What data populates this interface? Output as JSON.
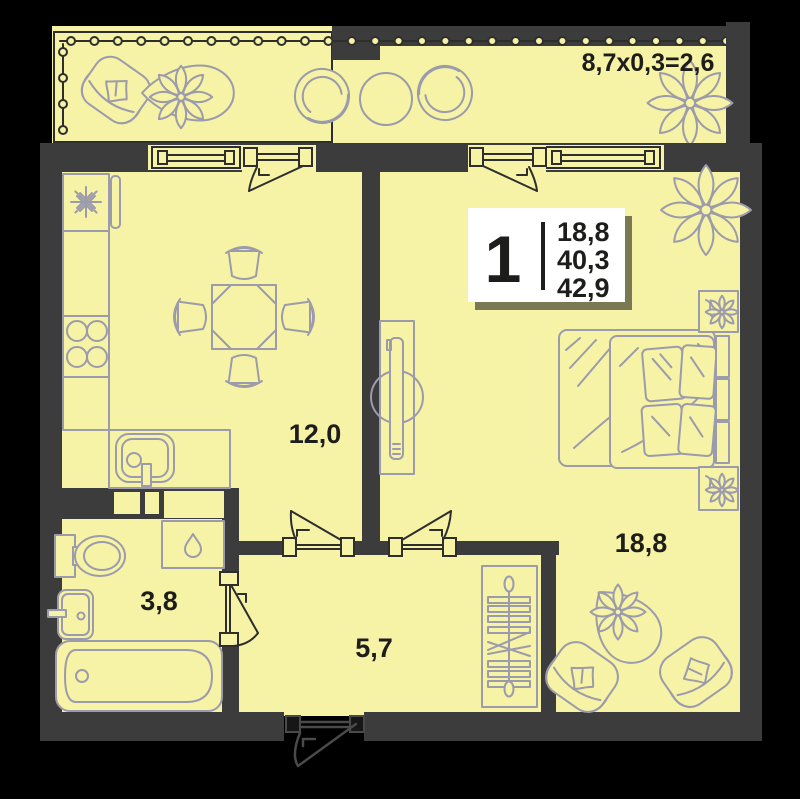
{
  "colors": {
    "background": "#000000",
    "floor": "#f6f2a6",
    "wall": "#3c3c3c",
    "frame": "#2e2e2e",
    "furniture": "#9b9bab",
    "text": "#1d1d1b",
    "info_box": "#ffffff",
    "entrance": "#4a4a4a"
  },
  "plan": {
    "type": "apartment-floor-plan",
    "balcony_dimension": "8,7x0,3=2,6",
    "info_box": {
      "rooms": "1",
      "areas": [
        "18,8",
        "40,3",
        "42,9"
      ]
    },
    "room_labels": {
      "living_kitchen": "12,0",
      "bedroom": "18,8",
      "bathroom": "3,8",
      "hallway": "5,7"
    }
  }
}
